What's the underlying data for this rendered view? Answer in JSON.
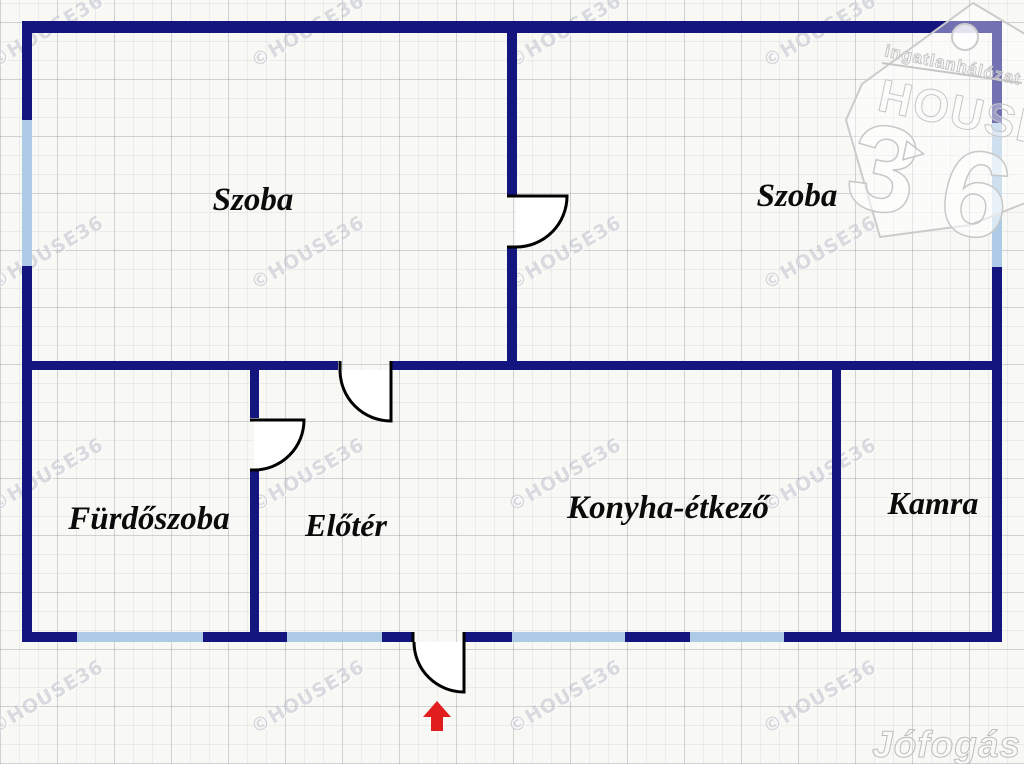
{
  "watermark": {
    "text": "©HOUSE36"
  },
  "brand_logo": {
    "tagline": "ingatlanhálózat",
    "name": "HOUSE",
    "number_left": "3",
    "number_right": "6"
  },
  "portal_watermark": {
    "text": "Jófogás"
  },
  "rooms": [
    {
      "id": "szoba-left",
      "label": "Szoba"
    },
    {
      "id": "szoba-right",
      "label": "Szoba"
    },
    {
      "id": "furdoszoba",
      "label": "Fürdőszoba"
    },
    {
      "id": "eloter",
      "label": "Előtér"
    },
    {
      "id": "konyha-etkezo",
      "label": "Konyha-étkező"
    },
    {
      "id": "kamra",
      "label": "Kamra"
    }
  ],
  "colors": {
    "wall": "#15157f",
    "window": "#adcae6",
    "door_line": "#000000",
    "entrance_arrow": "#e11d1d"
  },
  "entrance_indicator": "up-arrow"
}
